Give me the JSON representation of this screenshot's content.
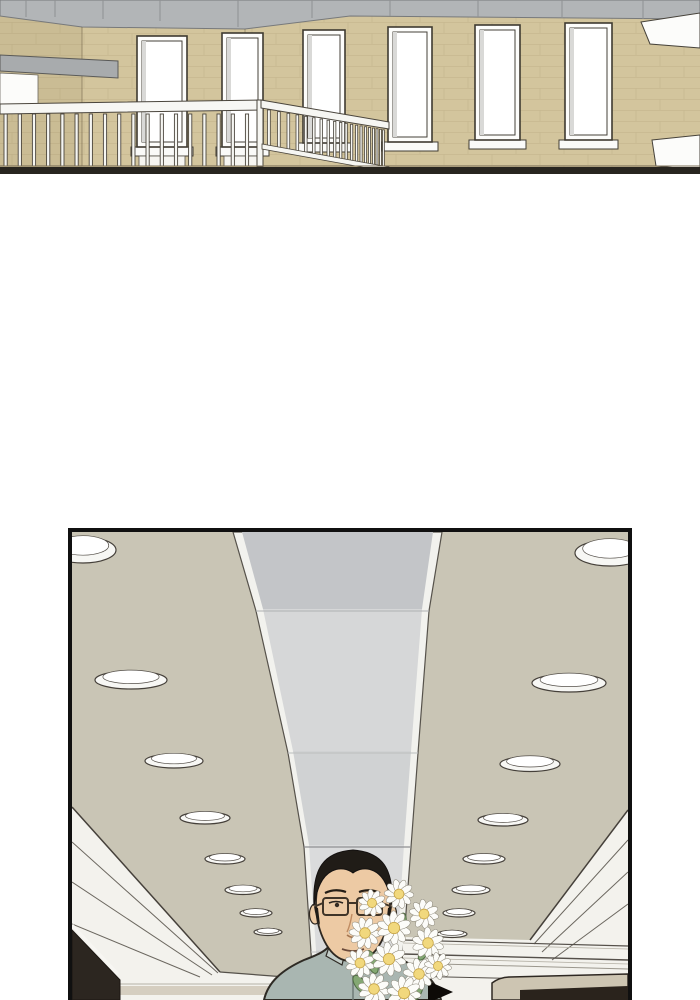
{
  "page": {
    "width": 700,
    "height": 1000,
    "background": "#ffffff",
    "kind": "webtoon-comic-page",
    "text_content": "none"
  },
  "palette": {
    "brick_wall": "#d3c59d",
    "mortar_line": "#bfb087",
    "ceiling_gray_band": "#b2b5b7",
    "window_white": "#fdfdfb",
    "railing_white": "#f6f6f2",
    "floor_dark": "#28251f",
    "lobby_ceiling": "#c9c5b5",
    "channel_gray_dark": "#c3c5c8",
    "channel_gray_light": "#d6d7d8",
    "cove_white": "#f3f2ed",
    "beige_band": "#d5cec0",
    "counter_beige": "#cdc5b2",
    "dark_brown": "#2c2620",
    "outline": "#2e2a24",
    "skin": "#edcaa4",
    "hair": "#201c17",
    "shirt": "#a9b6b1",
    "daisy_petal": "#fcfcf9",
    "daisy_center": "#f1d87d",
    "leaf_green": "#84a873",
    "arrow_black": "#0d0a07",
    "panel_border": "#101010"
  },
  "top_panel": {
    "w": 700,
    "h": 174,
    "shapes_bg": [
      {
        "t": "rect",
        "n": "brick-wall",
        "x": 0,
        "y": 14,
        "w": 700,
        "h": 153,
        "fill": "#d3c59d"
      },
      {
        "t": "rect",
        "n": "brick-texture",
        "x": 0,
        "y": 14,
        "w": 700,
        "h": 153,
        "fill": "url(#brick)",
        "opacity": 0.6
      },
      {
        "t": "rect",
        "n": "left-wall-shade",
        "x": 0,
        "y": 16,
        "w": 82,
        "h": 151,
        "fill": "rgba(60,50,20,0.06)"
      },
      {
        "t": "poly",
        "n": "ceiling-gray-band",
        "pts": "0,0 700,0 700,19 350,16 245,29 82,27 0,16",
        "fill": "#b2b5b7",
        "stroke": "#77797b",
        "sw": 1
      },
      {
        "t": "line",
        "n": "wall-corner-line",
        "x1": 82,
        "y1": 27,
        "x2": 82,
        "y2": 166,
        "stroke": "rgba(96,84,60,0.5)",
        "sw": 1
      },
      {
        "t": "line",
        "n": "wall-corner-line",
        "x1": 245,
        "y1": 29,
        "x2": 245,
        "y2": 166,
        "stroke": "rgba(96,84,60,0.45)",
        "sw": 1
      },
      {
        "t": "poly",
        "n": "gray-beam",
        "pts": "0,55 118,61 118,78 0,71",
        "fill": "#a8abad",
        "stroke": "#5a5a58",
        "sw": 1
      },
      {
        "t": "poly",
        "n": "door-opening",
        "pts": "0,73 38,75 38,109 0,108",
        "fill": "#fcfcfa",
        "stroke": "#6a665e",
        "sw": 0.8
      }
    ],
    "band_seams": [
      [
        26,
        17
      ],
      [
        55,
        17
      ],
      [
        103,
        19
      ],
      [
        160,
        21
      ],
      [
        238,
        27
      ],
      [
        312,
        18
      ],
      [
        390,
        16
      ],
      [
        478,
        17
      ],
      [
        562,
        18
      ],
      [
        643,
        19
      ]
    ],
    "windows": [
      {
        "x": 137,
        "y": 36,
        "w": 50,
        "h": 111,
        "apron": true
      },
      {
        "x": 222,
        "y": 33,
        "w": 41,
        "h": 114,
        "apron": true
      },
      {
        "x": 303,
        "y": 30,
        "w": 42,
        "h": 113,
        "apron": false
      },
      {
        "x": 388,
        "y": 27,
        "w": 44,
        "h": 115,
        "apron": false
      },
      {
        "x": 475,
        "y": 25,
        "w": 45,
        "h": 115,
        "apron": false
      },
      {
        "x": 565,
        "y": 23,
        "w": 47,
        "h": 117,
        "apron": false
      }
    ],
    "right_trims": [
      {
        "pts": "641,22 700,13 700,48 650,44"
      },
      {
        "pts": "652,140 700,135 700,170 656,166"
      }
    ],
    "railing": {
      "front": {
        "count": 19,
        "x0": 4,
        "dx": 14.2,
        "bw": 3.2,
        "y1": 114,
        "y2": 166
      },
      "front_rail_pts": "0,104 262,100 262,110 0,114",
      "corner_post": {
        "x": 257,
        "y": 100,
        "w": 6,
        "h": 67
      },
      "receding_rail_pts": "261,100 389,122 389,129 261,108",
      "receding_bottom_rail_pts": "262,144 389,167 389,172 262,149",
      "receding_xs": [
        267.5,
        277.5,
        287,
        296,
        304.5,
        312.5,
        320,
        327,
        333.5,
        339.5,
        345,
        350.5,
        355.5,
        360,
        364.5,
        368.5,
        372.5,
        376,
        379.5,
        382.5
      ],
      "rec_top": {
        "x0": 262,
        "y0": 104,
        "slope": 0.173
      },
      "rec_bot": {
        "x0": 262,
        "y0": 145,
        "slope": 0.185
      }
    },
    "shapes_fg": [
      {
        "t": "line",
        "n": "floor-edge-line",
        "x1": 0,
        "y1": 166,
        "x2": 700,
        "y2": 166,
        "stroke": "#7b6f58",
        "sw": 1
      },
      {
        "t": "rect",
        "n": "floor-dark-band",
        "x": 0,
        "y": 167,
        "w": 700,
        "h": 7,
        "fill": "#28251f"
      }
    ]
  },
  "bottom_panel": {
    "w": 556,
    "h": 468,
    "shapes_bg": [
      {
        "t": "rect",
        "n": "lobby-ceiling",
        "x": 0,
        "y": 0,
        "w": 556,
        "h": 468,
        "fill": "#c9c5b5"
      },
      {
        "t": "poly",
        "n": "channel-white-base",
        "pts": "161,0 370,0 357,79 346,221 339,315 331,420 327,468 242,468 239,420 232,315 216,221 184,79",
        "fill": "#f2f2ee",
        "stroke": "#56524b",
        "sw": 1.2
      },
      {
        "t": "poly",
        "n": "channel-segment-1",
        "pts": "170,0 361,0 350,77 191,77",
        "fill": "#c3c5c8"
      },
      {
        "t": "poly",
        "n": "channel-segment-2",
        "pts": "191,77 350,77 339,219 221,219",
        "fill": "#d6d7d8"
      },
      {
        "t": "poly",
        "n": "channel-segment-3",
        "pts": "221,219 339,219 332,313 237,313",
        "fill": "#d0d2d3"
      },
      {
        "t": "poly",
        "n": "channel-segment-4",
        "pts": "237,313 332,313 325,418 244,418",
        "fill": "#dadbdc"
      },
      {
        "t": "poly",
        "n": "channel-segment-5",
        "pts": "244,418 325,418 322,468 247,468",
        "fill": "#d3d4d5"
      },
      {
        "t": "line",
        "n": "channel-joint",
        "x1": 184,
        "y1": 79,
        "x2": 357,
        "y2": 79,
        "stroke": "#aeb0b2",
        "sw": 1
      },
      {
        "t": "line",
        "n": "channel-joint",
        "x1": 216,
        "y1": 221,
        "x2": 346,
        "y2": 221,
        "stroke": "#bbbdbe",
        "sw": 1
      },
      {
        "t": "line",
        "n": "channel-joint",
        "x1": 232,
        "y1": 315,
        "x2": 339,
        "y2": 315,
        "stroke": "#8f9092",
        "sw": 1.2
      },
      {
        "t": "line",
        "n": "channel-joint",
        "x1": 239,
        "y1": 420,
        "x2": 331,
        "y2": 420,
        "stroke": "#c2c3c4",
        "sw": 1
      },
      {
        "t": "poly",
        "n": "left-cove-white",
        "pts": "0,275 148,440 240,447 240,468 0,468",
        "fill": "#f3f2ed"
      },
      {
        "t": "line",
        "n": "left-cove-edge",
        "x1": 0,
        "y1": 275,
        "x2": 148,
        "y2": 440,
        "stroke": "#45403a",
        "sw": 1.5
      },
      {
        "t": "line",
        "n": "left-cove-louver",
        "x1": 0,
        "y1": 310,
        "x2": 146,
        "y2": 441,
        "stroke": "#6b675f",
        "sw": 1
      },
      {
        "t": "line",
        "n": "left-cove-louver",
        "x1": 0,
        "y1": 350,
        "x2": 140,
        "y2": 443,
        "stroke": "#6b675f",
        "sw": 1
      },
      {
        "t": "line",
        "n": "left-cove-louver",
        "x1": 0,
        "y1": 392,
        "x2": 128,
        "y2": 445,
        "stroke": "#6b675f",
        "sw": 1
      },
      {
        "t": "line",
        "n": "left-ceiling-bottom-edge",
        "x1": 148,
        "y1": 440,
        "x2": 240,
        "y2": 447,
        "stroke": "#55514a",
        "sw": 1.2
      },
      {
        "t": "line",
        "n": "left-fascia-line",
        "x1": 0,
        "y1": 452,
        "x2": 240,
        "y2": 452,
        "stroke": "#b5b1a6",
        "sw": 1
      },
      {
        "t": "poly",
        "n": "left-beige-band",
        "pts": "0,454 240,454 240,463 0,463",
        "fill": "#d5cec0"
      },
      {
        "t": "poly",
        "n": "left-dark-corner",
        "pts": "0,398 48,448 48,468 0,468",
        "fill": "#2c2620",
        "stroke": "#1c1712",
        "sw": 1
      },
      {
        "t": "line",
        "n": "left-corner-trim",
        "x1": 0,
        "y1": 393,
        "x2": 46,
        "y2": 442,
        "stroke": "#f7f6f2",
        "sw": 3
      },
      {
        "t": "poly",
        "n": "right-cove-white",
        "pts": "331,405 458,408 556,278 556,468 331,468",
        "fill": "#f3f2ed"
      },
      {
        "t": "line",
        "n": "right-cove-edge",
        "x1": 458,
        "y1": 408,
        "x2": 556,
        "y2": 278,
        "stroke": "#45403a",
        "sw": 1.5
      },
      {
        "t": "line",
        "n": "right-cove-louver",
        "x1": 462,
        "y1": 412,
        "x2": 556,
        "y2": 308,
        "stroke": "#6b675f",
        "sw": 1
      },
      {
        "t": "line",
        "n": "right-cove-louver",
        "x1": 470,
        "y1": 420,
        "x2": 556,
        "y2": 340,
        "stroke": "#6b675f",
        "sw": 1
      },
      {
        "t": "line",
        "n": "right-cove-louver",
        "x1": 480,
        "y1": 428,
        "x2": 556,
        "y2": 372,
        "stroke": "#6b675f",
        "sw": 1
      },
      {
        "t": "line",
        "n": "right-band-line",
        "x1": 331,
        "y1": 408,
        "x2": 556,
        "y2": 414,
        "stroke": "#55504a",
        "sw": 1.2
      },
      {
        "t": "line",
        "n": "right-band-line",
        "x1": 331,
        "y1": 411,
        "x2": 556,
        "y2": 417,
        "stroke": "#b5b1a6",
        "sw": 0.8
      },
      {
        "t": "line",
        "n": "right-band-line",
        "x1": 331,
        "y1": 422,
        "x2": 556,
        "y2": 428,
        "stroke": "#55504a",
        "sw": 1.4
      },
      {
        "t": "line",
        "n": "right-band-line",
        "x1": 331,
        "y1": 426,
        "x2": 556,
        "y2": 432,
        "stroke": "#b5b1a6",
        "sw": 0.8
      },
      {
        "t": "line",
        "n": "right-band-line",
        "x1": 331,
        "y1": 431,
        "x2": 556,
        "y2": 437,
        "stroke": "#9b978d",
        "sw": 1
      },
      {
        "t": "line",
        "n": "right-band-line",
        "x1": 331,
        "y1": 444,
        "x2": 556,
        "y2": 449,
        "stroke": "#55504a",
        "sw": 1
      },
      {
        "t": "path",
        "n": "counter-top",
        "d": "M420,451 Q428,445 438,445 L556,442 L556,468 L420,468 Z",
        "fill": "#cdc5b2",
        "stroke": "#2e2822",
        "sw": 1.5
      },
      {
        "t": "poly",
        "n": "counter-dark-front",
        "pts": "448,458 556,454 556,468 448,468",
        "fill": "#2a231c"
      }
    ],
    "lights_left": [
      {
        "cx": 11,
        "cy": 18,
        "rx": 33,
        "ry": 13
      },
      {
        "cx": 59,
        "cy": 148,
        "rx": 36,
        "ry": 9
      },
      {
        "cx": 102,
        "cy": 229,
        "rx": 29,
        "ry": 7
      },
      {
        "cx": 133,
        "cy": 286,
        "rx": 25,
        "ry": 6
      },
      {
        "cx": 153,
        "cy": 327,
        "rx": 20,
        "ry": 5
      },
      {
        "cx": 171,
        "cy": 358,
        "rx": 18,
        "ry": 4.5
      },
      {
        "cx": 184,
        "cy": 381,
        "rx": 16,
        "ry": 4
      },
      {
        "cx": 196,
        "cy": 400,
        "rx": 14,
        "ry": 3.5
      }
    ],
    "lights_right": [
      {
        "cx": 538,
        "cy": 21,
        "rx": 35,
        "ry": 13
      },
      {
        "cx": 497,
        "cy": 151,
        "rx": 37,
        "ry": 9
      },
      {
        "cx": 458,
        "cy": 232,
        "rx": 30,
        "ry": 7.5
      },
      {
        "cx": 431,
        "cy": 288,
        "rx": 25,
        "ry": 6
      },
      {
        "cx": 412,
        "cy": 327,
        "rx": 21,
        "ry": 5
      },
      {
        "cx": 399,
        "cy": 358,
        "rx": 19,
        "ry": 4.5
      },
      {
        "cx": 387,
        "cy": 381,
        "rx": 16,
        "ry": 4
      },
      {
        "cx": 380,
        "cy": 402,
        "rx": 15,
        "ry": 3.5
      }
    ],
    "man": [
      {
        "t": "path",
        "n": "man-neck",
        "d": "M262,396 L300,396 L300,430 L262,430 Z",
        "fill": "#edcaa4",
        "stroke": "#2e2821",
        "sw": 1.4
      },
      {
        "t": "ellipse",
        "n": "man-neck-shadow",
        "cx": 281,
        "cy": 408,
        "rx": 19,
        "ry": 8,
        "fill": "#d8a982"
      },
      {
        "t": "path",
        "n": "man-shirt",
        "d": "M192,468 C196,450 210,438 232,428 C248,422 256,418 260,410 L262,404 L300,404 L302,410 C306,418 314,422 330,428 C352,438 365,450 369,468 Z",
        "fill": "#a9b6b1",
        "stroke": "#2e2a24",
        "sw": 2
      },
      {
        "t": "path",
        "n": "man-collar-left",
        "d": "M260,406 L254,424 L270,433 L275,413 Z",
        "fill": "#c3cdc8",
        "stroke": "#2e2a24",
        "sw": 1.2
      },
      {
        "t": "path",
        "n": "man-collar-right",
        "d": "M302,406 L308,424 L292,433 L287,413 Z",
        "fill": "#c3cdc8",
        "stroke": "#2e2a24",
        "sw": 1.2
      },
      {
        "t": "line",
        "n": "man-shirt-placket",
        "x1": 281,
        "y1": 433,
        "x2": 281,
        "y2": 468,
        "stroke": "#6e7a76",
        "sw": 1.5
      },
      {
        "t": "ellipse",
        "n": "man-ear-left",
        "cx": 243,
        "cy": 382,
        "rx": 5.5,
        "ry": 10,
        "fill": "#edcaa4",
        "stroke": "#2e2821",
        "sw": 1.2
      },
      {
        "t": "ellipse",
        "n": "man-ear-right",
        "cx": 319,
        "cy": 382,
        "rx": 5.5,
        "ry": 10,
        "fill": "#edcaa4",
        "stroke": "#2e2821",
        "sw": 1.2
      },
      {
        "t": "path",
        "n": "man-face",
        "d": "M244,372 C244,340 258,324 281,324 C304,324 318,340 318,372 C318,396 308,420 293,427 Q281,432 269,427 C254,420 244,396 244,372 Z",
        "fill": "#edcaa4",
        "stroke": "#2e2821",
        "sw": 1.8
      },
      {
        "t": "path",
        "n": "man-hair",
        "d": "M242,374 C240,336 252,320 281,318 C310,320 322,336 320,374 C317,356 312,344 302,339 C294,335 286,337 281,341 C276,337 268,335 260,339 C250,344 245,356 242,374 Z",
        "fill": "#201c17",
        "stroke": "#141110",
        "sw": 1
      },
      {
        "t": "path",
        "n": "man-hair-sideburn-left",
        "d": "M242,374 C243,382 245,388 248,393 L246,376 Z",
        "fill": "#201c17"
      },
      {
        "t": "path",
        "n": "man-hair-sideburn-right",
        "d": "M320,374 C319,382 317,388 314,393 L316,376 Z",
        "fill": "#201c17"
      },
      {
        "t": "path",
        "n": "man-eyebrow-left",
        "d": "M253,361 Q263,356 274,360",
        "fill": "none",
        "stroke": "#241d15",
        "sw": 2.2
      },
      {
        "t": "path",
        "n": "man-eyebrow-right",
        "d": "M287,360 Q298,356 308,361",
        "fill": "none",
        "stroke": "#241d15",
        "sw": 2.2
      },
      {
        "t": "path",
        "n": "man-eye-left",
        "d": "M257,371 Q264,368 271,371",
        "fill": "none",
        "stroke": "#1d1812",
        "sw": 1.6
      },
      {
        "t": "circle",
        "n": "man-pupil-left",
        "cx": 265,
        "cy": 373,
        "r": 2.2,
        "fill": "#2a2119"
      },
      {
        "t": "path",
        "n": "man-eye-right",
        "d": "M290,371 Q297,368 304,371",
        "fill": "none",
        "stroke": "#1d1812",
        "sw": 1.6
      },
      {
        "t": "circle",
        "n": "man-pupil-right",
        "cx": 296,
        "cy": 373,
        "r": 2.2,
        "fill": "#2a2119"
      },
      {
        "t": "rect",
        "n": "man-glasses-left-lens",
        "x": 251,
        "y": 366,
        "w": 25,
        "h": 17,
        "rx": 3,
        "fill": "rgba(255,255,255,0.05)",
        "stroke": "#3f3428",
        "sw": 2
      },
      {
        "t": "rect",
        "n": "man-glasses-right-lens",
        "x": 285,
        "y": 366,
        "w": 25,
        "h": 17,
        "rx": 3,
        "fill": "rgba(255,255,255,0.05)",
        "stroke": "#3f3428",
        "sw": 2
      },
      {
        "t": "line",
        "n": "man-glasses-bridge",
        "x1": 276,
        "y1": 371,
        "x2": 285,
        "y2": 371,
        "stroke": "#3f3428",
        "sw": 2
      },
      {
        "t": "line",
        "n": "man-glasses-temple-left",
        "x1": 251,
        "y1": 371,
        "x2": 244,
        "y2": 374,
        "stroke": "#3f3428",
        "sw": 1.8
      },
      {
        "t": "line",
        "n": "man-glasses-temple-right",
        "x1": 310,
        "y1": 371,
        "x2": 318,
        "y2": 374,
        "stroke": "#3f3428",
        "sw": 1.8
      },
      {
        "t": "path",
        "n": "man-nose",
        "d": "M280,382 Q278,394 275,400",
        "fill": "none",
        "stroke": "#c08c62",
        "sw": 1.4
      },
      {
        "t": "path",
        "n": "man-nose-tip",
        "d": "M275,403 Q280,407 286,404",
        "fill": "none",
        "stroke": "#a5754f",
        "sw": 1.6
      },
      {
        "t": "path",
        "n": "man-mouth",
        "d": "M270,417 Q281,421 292,417",
        "fill": "none",
        "stroke": "#6b4a3a",
        "sw": 1.8
      }
    ],
    "arrow": {
      "pts": "356,449 381,460 356,471",
      "fill": "#0d0a07"
    },
    "leaves": [
      {
        "cx": 300,
        "cy": 430,
        "rx": 5,
        "ry": 12,
        "rot": -20
      },
      {
        "cx": 345,
        "cy": 455,
        "rx": 6,
        "ry": 14,
        "rot": 15
      },
      {
        "cx": 288,
        "cy": 452,
        "rx": 5,
        "ry": 10,
        "rot": -35
      },
      {
        "cx": 330,
        "cy": 390,
        "rx": 4,
        "ry": 9,
        "rot": 10
      },
      {
        "cx": 352,
        "cy": 420,
        "rx": 4,
        "ry": 9,
        "rot": 30
      }
    ],
    "stems": [
      {
        "d": "M310,455 L305,468"
      },
      {
        "d": "M320,458 L318,468"
      }
    ],
    "flowers": [
      {
        "cx": 300,
        "cy": 371,
        "r": 12
      },
      {
        "cx": 327,
        "cy": 362,
        "r": 13
      },
      {
        "cx": 352,
        "cy": 382,
        "r": 13
      },
      {
        "cx": 293,
        "cy": 401,
        "r": 14
      },
      {
        "cx": 322,
        "cy": 396,
        "r": 15
      },
      {
        "cx": 356,
        "cy": 411,
        "r": 14
      },
      {
        "cx": 288,
        "cy": 431,
        "r": 13
      },
      {
        "cx": 317,
        "cy": 427,
        "r": 15
      },
      {
        "cx": 347,
        "cy": 442,
        "r": 14
      },
      {
        "cx": 302,
        "cy": 457,
        "r": 14
      },
      {
        "cx": 332,
        "cy": 461,
        "r": 15
      },
      {
        "cx": 366,
        "cy": 434,
        "r": 12
      }
    ]
  }
}
